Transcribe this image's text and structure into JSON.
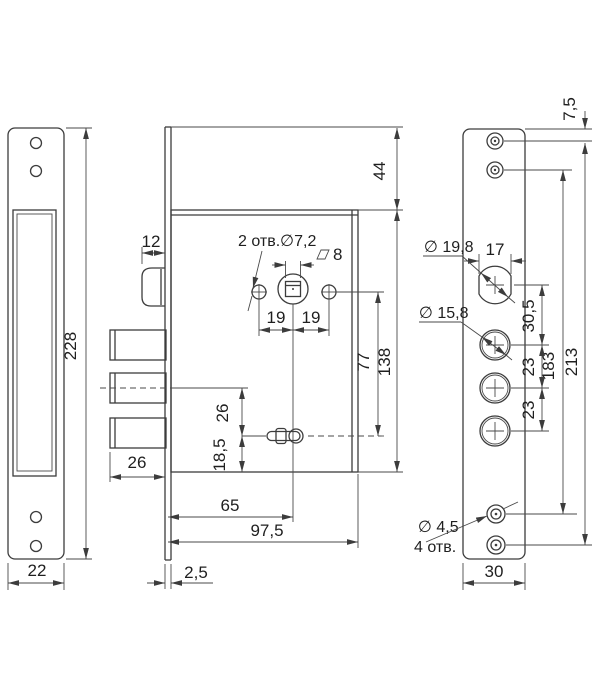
{
  "title": "lock-technical-drawing",
  "colors": {
    "background": "#ffffff",
    "object_line": "#3c3c3c",
    "dim_line": "#4a4a4a",
    "text": "#1f1f1f"
  },
  "labels": {
    "front_plate": {
      "height": "228",
      "width": "22"
    },
    "side_view": {
      "latch_protrusion": "12",
      "face_holes": "2 отв.∅7,2",
      "square": "8",
      "pitch_left": "19",
      "pitch_right": "19",
      "top_offset": "44",
      "body_height": "138",
      "hole_to_keyhole": "77",
      "bolt_throw": "26",
      "axis_to_keyhole": "26",
      "keyhole_to_bottom": "18,5",
      "backset": "65",
      "body_depth": "97,5",
      "plate_thickness": "2,5"
    },
    "back_plate": {
      "top_hole_offset": "7,5",
      "cyl_width": "17",
      "cyl_dia": "∅ 19,8",
      "hole_dia": "∅ 15,8",
      "cyl_pitch": "30,5",
      "pitch1": "23",
      "pitch2": "23",
      "span_inner": "183",
      "span_outer": "213",
      "screw_dia": "∅ 4,5",
      "screw_count": "4 отв.",
      "width": "30"
    }
  }
}
